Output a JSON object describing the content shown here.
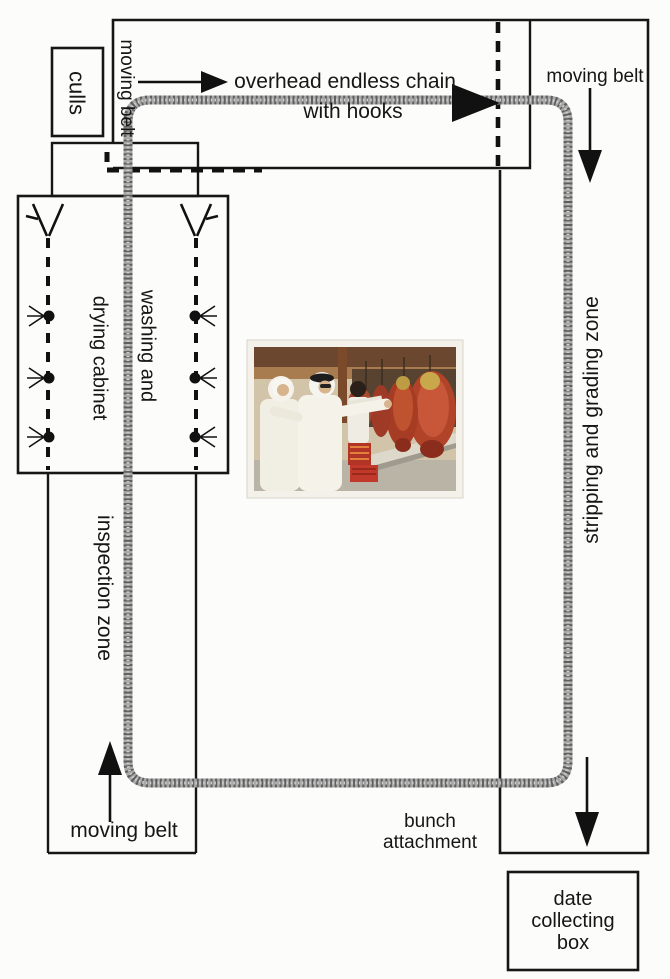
{
  "diagram": {
    "title_labels": {
      "overhead_chain_line1": "overhead endless chain",
      "overhead_chain_line2": "with hooks"
    },
    "labels": {
      "culls": "culls",
      "moving_belt_top": "moving belt",
      "moving_belt_right": "moving belt",
      "moving_belt_bottom": "moving belt",
      "stripping_zone": "stripping and grading zone",
      "washing_line1": "washing and",
      "washing_line2": "drying cabinet",
      "inspection_zone": "inspection zone",
      "bunch_line1": "bunch",
      "bunch_line2": "attachment"
    },
    "date_box_lines": [
      "date",
      "collecting",
      "box"
    ],
    "icons": {
      "chain": "endless-chain-loop",
      "arrows": [
        "flow-arrow-right",
        "chain-arrowhead-right",
        "flow-arrow-down-right-top",
        "flow-arrow-up-bottom-left",
        "flow-arrow-down-bottom-right"
      ],
      "nozzles": "spray-nozzle",
      "dashed_path": "culls-return-path"
    },
    "colors": {
      "line": "#161616",
      "chain_gray": "#a8a8a8",
      "chain_texture": "#5f5f5f",
      "dates_red": "#b04328",
      "photo_wall": "#d2c4a8",
      "photo_wood": "#6b4730"
    },
    "photo_alt": "workers in white robes pointing at hanging red date bunches"
  }
}
